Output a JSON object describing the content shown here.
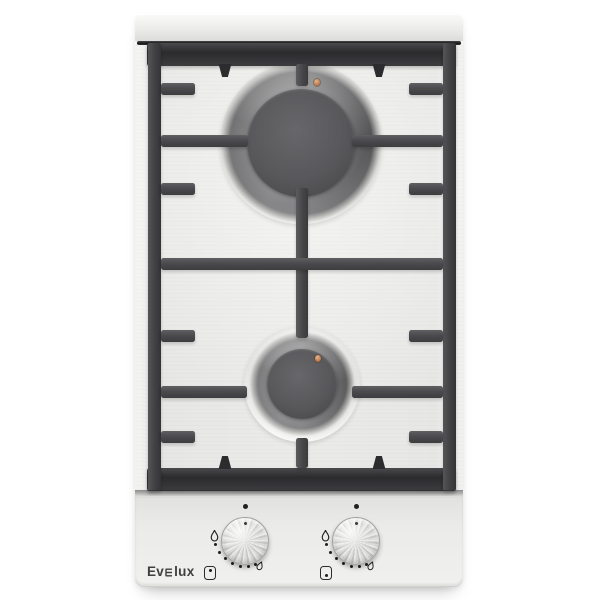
{
  "background_color": "#ffffff",
  "brand": {
    "label": "Evelux",
    "prefix": "Ev",
    "suffix": "lux",
    "stylized_letter": "e"
  },
  "palette": {
    "bg": "#ffffff",
    "steel": "#ebebe9",
    "grate": "#4b4b4e",
    "grate_dark": "#2c2c2f",
    "burner_cap": "#58585b",
    "ignition_electrode": "#c28258",
    "marking": "#202020",
    "logo": "#3f3f3f"
  },
  "hob": {
    "burners": [
      {
        "name": "rear-burner",
        "size": "large"
      },
      {
        "name": "front-burner",
        "size": "small"
      }
    ],
    "controls": [
      {
        "name": "rear-burner-knob",
        "burner_position_indicator": "dot-top",
        "dial_marks": {
          "flame_high_icon": true,
          "flame_low_icon": true,
          "level_dots": 7,
          "off_dot": true
        }
      },
      {
        "name": "front-burner-knob",
        "burner_position_indicator": "dot-bottom",
        "dial_marks": {
          "flame_high_icon": true,
          "flame_low_icon": true,
          "level_dots": 7,
          "off_dot": true
        }
      }
    ],
    "icons": {
      "flame_high": "flame-high-icon",
      "flame_low": "flame-low-icon",
      "rear_position": "burner-position-rear-icon",
      "front_position": "burner-position-front-icon"
    }
  }
}
